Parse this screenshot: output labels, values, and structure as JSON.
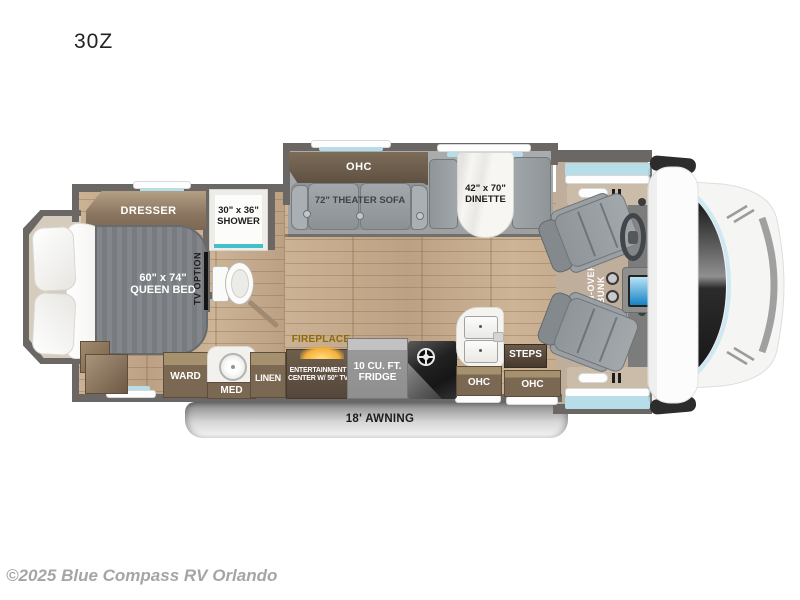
{
  "title": "30Z",
  "copyright": "©2025 Blue Compass RV Orlando",
  "colors": {
    "wall": "#6b6765",
    "wood_floor": "#c7ad8e",
    "slide_floor": "#a4a6a7",
    "cab_floor": "#bfae9b",
    "cabinet_brown": "#7b6852",
    "cabinet_dark_brown": "#5d4f41",
    "shower_accent_teal": "#45c0cb",
    "window_glass_blue": "#b7dde9",
    "fireplace_gold": "#8f6b05",
    "sofa_gray": "#9aa0a3"
  },
  "bedroom": {
    "dresser": "DRESSER",
    "bed": [
      "60\" x 74\"",
      "QUEEN BED"
    ],
    "tv_option": "TV OPTION"
  },
  "bath": {
    "shower": [
      "30\" x 36\"",
      "SHOWER"
    ]
  },
  "living": {
    "ohc": "OHC",
    "sofa": "72\" THEATER SOFA",
    "dinette": [
      "42\" x 70\"",
      "DINETTE"
    ]
  },
  "kitchen": {
    "ward": "WARD",
    "med": "MED",
    "linen": "LINEN",
    "fireplace": "FIREPLACE",
    "entertainment": [
      "ENTERTAINMENT",
      "CENTER W/ 50\" TV"
    ],
    "fridge": [
      "10 CU. FT.",
      "FRIDGE"
    ],
    "ohc_left": "OHC",
    "steps": "STEPS",
    "ohc_right": "OHC"
  },
  "cab": {
    "bunk": [
      "CAB-OVER",
      "BUNK"
    ]
  },
  "exterior": {
    "awning": "18' AWNING"
  }
}
